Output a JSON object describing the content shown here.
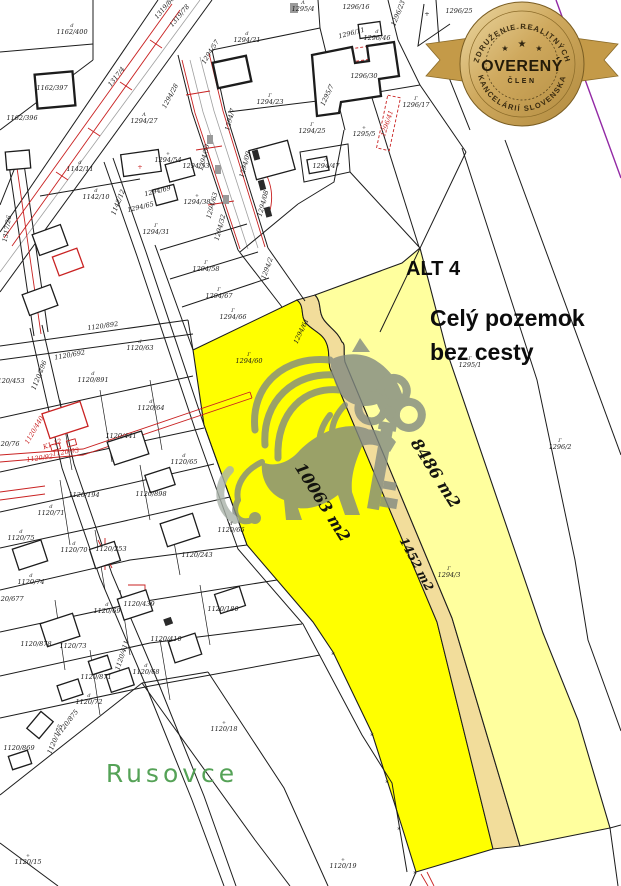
{
  "annotations": {
    "alt": "ALT 4",
    "note_line1": "Celý pozemok",
    "note_line2": "bez cesty",
    "place": "Rusovce"
  },
  "areas": {
    "main": "10063 m2",
    "secondary": "8486 m2",
    "road": "1452 m2"
  },
  "badge": {
    "top_arc": "ZDRUŽENIE REALITNÝCH",
    "center": "OVERENÝ",
    "member": "ČLEN",
    "bottom_arc": "KANCELÁRIÍ SLOVENSKA",
    "stars": [
      "★",
      "★",
      "★"
    ]
  },
  "colors": {
    "line": "#1c1c1c",
    "red": "#c92222",
    "gray": "#a0a0a0",
    "magenta": "#9229a5",
    "green": "#55a257",
    "watermark": "#828a82",
    "highlight_main": "#ffff00",
    "highlight_side": "#ffff9e",
    "road_strip": "#f2dd9b",
    "badge_gold": "#c9a558",
    "badge_gold_light": "#e9d195",
    "badge_gold_dark": "#9c7830"
  },
  "map": {
    "labels": [
      {
        "t": "1162/400",
        "x": 72,
        "y": 34,
        "sym": "d"
      },
      {
        "t": "1162/397",
        "x": 52,
        "y": 90
      },
      {
        "t": "1162/396",
        "x": 22,
        "y": 120
      },
      {
        "t": "1317/4",
        "x": 118,
        "y": 78,
        "r": -52
      },
      {
        "t": "1319/80",
        "x": 166,
        "y": 9,
        "r": -50,
        "s": 5.5
      },
      {
        "t": "1319/78",
        "x": 181,
        "y": 17,
        "r": -50,
        "s": 5.5
      },
      {
        "t": "1294/28",
        "x": 172,
        "y": 97,
        "r": -62,
        "s": 5.5
      },
      {
        "t": "1294/27",
        "x": 144,
        "y": 123,
        "sym": "Λ"
      },
      {
        "t": "1295/4",
        "x": 303,
        "y": 11,
        "sym": "Λ"
      },
      {
        "t": "1296/16",
        "x": 356,
        "y": 9
      },
      {
        "t": "1296/23",
        "x": 400,
        "y": 14,
        "r": -68,
        "s": 5.5
      },
      {
        "t": "1296/25",
        "x": 459,
        "y": 13,
        "s": 5.5
      },
      {
        "t": "+",
        "x": 427,
        "y": 16,
        "s": 8
      },
      {
        "t": "1294/21",
        "x": 247,
        "y": 42,
        "sym": "d"
      },
      {
        "t": "1294/57",
        "x": 212,
        "y": 53,
        "r": -58,
        "s": 5.5
      },
      {
        "t": "1294/23",
        "x": 270,
        "y": 104,
        "sym": "Γ"
      },
      {
        "t": "1296/11",
        "x": 352,
        "y": 35,
        "r": -15,
        "s": 5.5
      },
      {
        "t": "1296/46",
        "x": 377,
        "y": 40,
        "s": 5.5,
        "sym": "d"
      },
      {
        "t": "1296/30",
        "x": 364,
        "y": 78
      },
      {
        "t": "1295/7",
        "x": 329,
        "y": 96,
        "r": -65
      },
      {
        "t": "1296/17",
        "x": 416,
        "y": 107,
        "sym": "Γ"
      },
      {
        "t": "1296/41",
        "x": 389,
        "y": 124,
        "r": -72,
        "c": "red",
        "s": 5.5
      },
      {
        "t": "1295/5",
        "x": 364,
        "y": 136,
        "sym": "+"
      },
      {
        "t": "1294/25",
        "x": 312,
        "y": 133,
        "sym": "Γ"
      },
      {
        "t": "1294/47",
        "x": 326,
        "y": 168,
        "s": 5.5,
        "sym": "Λ"
      },
      {
        "t": "1142/11",
        "x": 80,
        "y": 171,
        "sym": "d"
      },
      {
        "t": "1142/10",
        "x": 96,
        "y": 199,
        "sym": "d"
      },
      {
        "t": "1142/12",
        "x": 120,
        "y": 203,
        "r": -68,
        "s": 5.5
      },
      {
        "t": "1317/26",
        "x": 9,
        "y": 229,
        "r": -80,
        "s": 5.5
      },
      {
        "t": "1294/54",
        "x": 168,
        "y": 162,
        "sym": "+"
      },
      {
        "t": "+",
        "x": 140,
        "y": 169,
        "c": "red",
        "s": 7
      },
      {
        "t": "1294/53",
        "x": 196,
        "y": 168,
        "s": 5
      },
      {
        "t": "1294/69",
        "x": 158,
        "y": 193,
        "r": -14,
        "s": 5.5
      },
      {
        "t": "1294/65",
        "x": 141,
        "y": 209,
        "r": -14,
        "s": 5.5
      },
      {
        "t": "1294/38",
        "x": 197,
        "y": 204,
        "sym": "+"
      },
      {
        "t": "1294/31",
        "x": 156,
        "y": 234,
        "sym": "Γ"
      },
      {
        "t": "1294/30",
        "x": 206,
        "y": 158,
        "r": -75,
        "s": 5
      },
      {
        "t": "1294/63",
        "x": 214,
        "y": 206,
        "r": -75,
        "s": 5
      },
      {
        "t": "1294/32",
        "x": 222,
        "y": 228,
        "r": -75,
        "s": 5
      },
      {
        "t": "1294/09",
        "x": 247,
        "y": 165,
        "r": -75,
        "s": 5
      },
      {
        "t": "1294/08",
        "x": 265,
        "y": 204,
        "r": -75,
        "s": 5
      },
      {
        "t": "1294/7",
        "x": 232,
        "y": 120,
        "r": -75,
        "s": 5
      },
      {
        "t": "1294/2",
        "x": 269,
        "y": 269,
        "r": -70,
        "s": 5.5
      },
      {
        "t": "1294/58",
        "x": 206,
        "y": 271,
        "sym": "Γ"
      },
      {
        "t": "1294/67",
        "x": 219,
        "y": 298,
        "sym": "Γ"
      },
      {
        "t": "1294/66",
        "x": 233,
        "y": 319,
        "sym": "Γ"
      },
      {
        "t": "1294/60",
        "x": 249,
        "y": 363,
        "sym": "Γ"
      },
      {
        "t": "1294/61",
        "x": 303,
        "y": 332,
        "r": -65,
        "s": 5.5
      },
      {
        "t": "1295/1",
        "x": 470,
        "y": 367,
        "sym": "Γ"
      },
      {
        "t": "1296/2",
        "x": 560,
        "y": 449,
        "sym": "Γ"
      },
      {
        "t": "1294/3",
        "x": 449,
        "y": 577,
        "sym": "Γ"
      },
      {
        "t": "1120/892",
        "x": 103,
        "y": 328,
        "r": -8,
        "s": 5.5
      },
      {
        "t": "1120/692",
        "x": 70,
        "y": 357,
        "r": -10,
        "s": 5.5
      },
      {
        "t": "1120/891",
        "x": 93,
        "y": 382,
        "sym": "d"
      },
      {
        "t": "1120/63",
        "x": 140,
        "y": 350,
        "sym": "d"
      },
      {
        "t": "1120/64",
        "x": 151,
        "y": 410,
        "sym": "d"
      },
      {
        "t": "1120/441",
        "x": 121,
        "y": 438
      },
      {
        "t": "1120/65",
        "x": 184,
        "y": 464,
        "sym": "d"
      },
      {
        "t": "1120/898",
        "x": 151,
        "y": 496
      },
      {
        "t": "1120/194",
        "x": 84,
        "y": 497
      },
      {
        "t": "1120/440",
        "x": 36,
        "y": 431,
        "r": -60,
        "c": "red",
        "s": 5.5
      },
      {
        "t": "1120/76",
        "x": 6,
        "y": 446,
        "s": 5.5
      },
      {
        "t": "1120/453",
        "x": 9,
        "y": 383,
        "s": 5
      },
      {
        "t": "1120/296",
        "x": 41,
        "y": 376,
        "r": -68,
        "s": 5.5
      },
      {
        "t": "K1-12",
        "x": 53,
        "y": 446,
        "r": -20,
        "c": "red",
        "s": 5.5
      },
      {
        "t": "1120/92",
        "x": 40,
        "y": 460,
        "r": -8,
        "c": "red",
        "s": 4.5
      },
      {
        "t": "1120/93",
        "x": 66,
        "y": 454,
        "r": -8,
        "c": "red",
        "s": 4.5
      },
      {
        "t": "1120/71",
        "x": 51,
        "y": 515,
        "sym": "d"
      },
      {
        "t": "1120/75",
        "x": 21,
        "y": 540,
        "sym": "d"
      },
      {
        "t": "1120/70",
        "x": 74,
        "y": 552,
        "sym": "d"
      },
      {
        "t": "1120/253",
        "x": 111,
        "y": 551
      },
      {
        "t": "1120/243",
        "x": 197,
        "y": 557
      },
      {
        "t": "1120/66",
        "x": 231,
        "y": 532,
        "sym": "d"
      },
      {
        "t": "1120/74",
        "x": 31,
        "y": 584,
        "sym": "d"
      },
      {
        "t": "1120/677",
        "x": 8,
        "y": 601
      },
      {
        "t": "1120/439",
        "x": 139,
        "y": 606
      },
      {
        "t": "1120/69",
        "x": 107,
        "y": 613,
        "sym": "d"
      },
      {
        "t": "1120/180",
        "x": 223,
        "y": 611
      },
      {
        "t": "1120/410",
        "x": 166,
        "y": 641
      },
      {
        "t": "1120/878",
        "x": 36,
        "y": 646,
        "s": 5
      },
      {
        "t": "1120/73",
        "x": 73,
        "y": 648,
        "s": 5
      },
      {
        "t": "1120/871",
        "x": 96,
        "y": 679
      },
      {
        "t": "1120/68",
        "x": 146,
        "y": 674,
        "sym": "d"
      },
      {
        "t": "1120/411",
        "x": 124,
        "y": 656,
        "r": -72,
        "s": 5.5
      },
      {
        "t": "1120/72",
        "x": 89,
        "y": 704,
        "sym": "d"
      },
      {
        "t": "1120/875",
        "x": 69,
        "y": 724,
        "r": -52,
        "s": 5
      },
      {
        "t": "1120/175",
        "x": 57,
        "y": 740,
        "r": -68,
        "s": 5.5
      },
      {
        "t": "1120/869",
        "x": 19,
        "y": 750,
        "s": 5.5
      },
      {
        "t": "1120/18",
        "x": 224,
        "y": 731,
        "sym": "+"
      },
      {
        "t": "1120/15",
        "x": 28,
        "y": 864,
        "sym": "+"
      },
      {
        "t": "1120/19",
        "x": 343,
        "y": 868,
        "sym": "+"
      },
      {
        "t": "*",
        "x": 333,
        "y": 657,
        "s": 13
      },
      {
        "t": "*",
        "x": 372,
        "y": 738,
        "s": 13
      },
      {
        "t": "*",
        "x": 387,
        "y": 785,
        "s": 13
      },
      {
        "t": "*",
        "x": 399,
        "y": 832,
        "s": 13
      },
      {
        "t": "*",
        "x": 415,
        "y": 876,
        "s": 13
      }
    ]
  }
}
